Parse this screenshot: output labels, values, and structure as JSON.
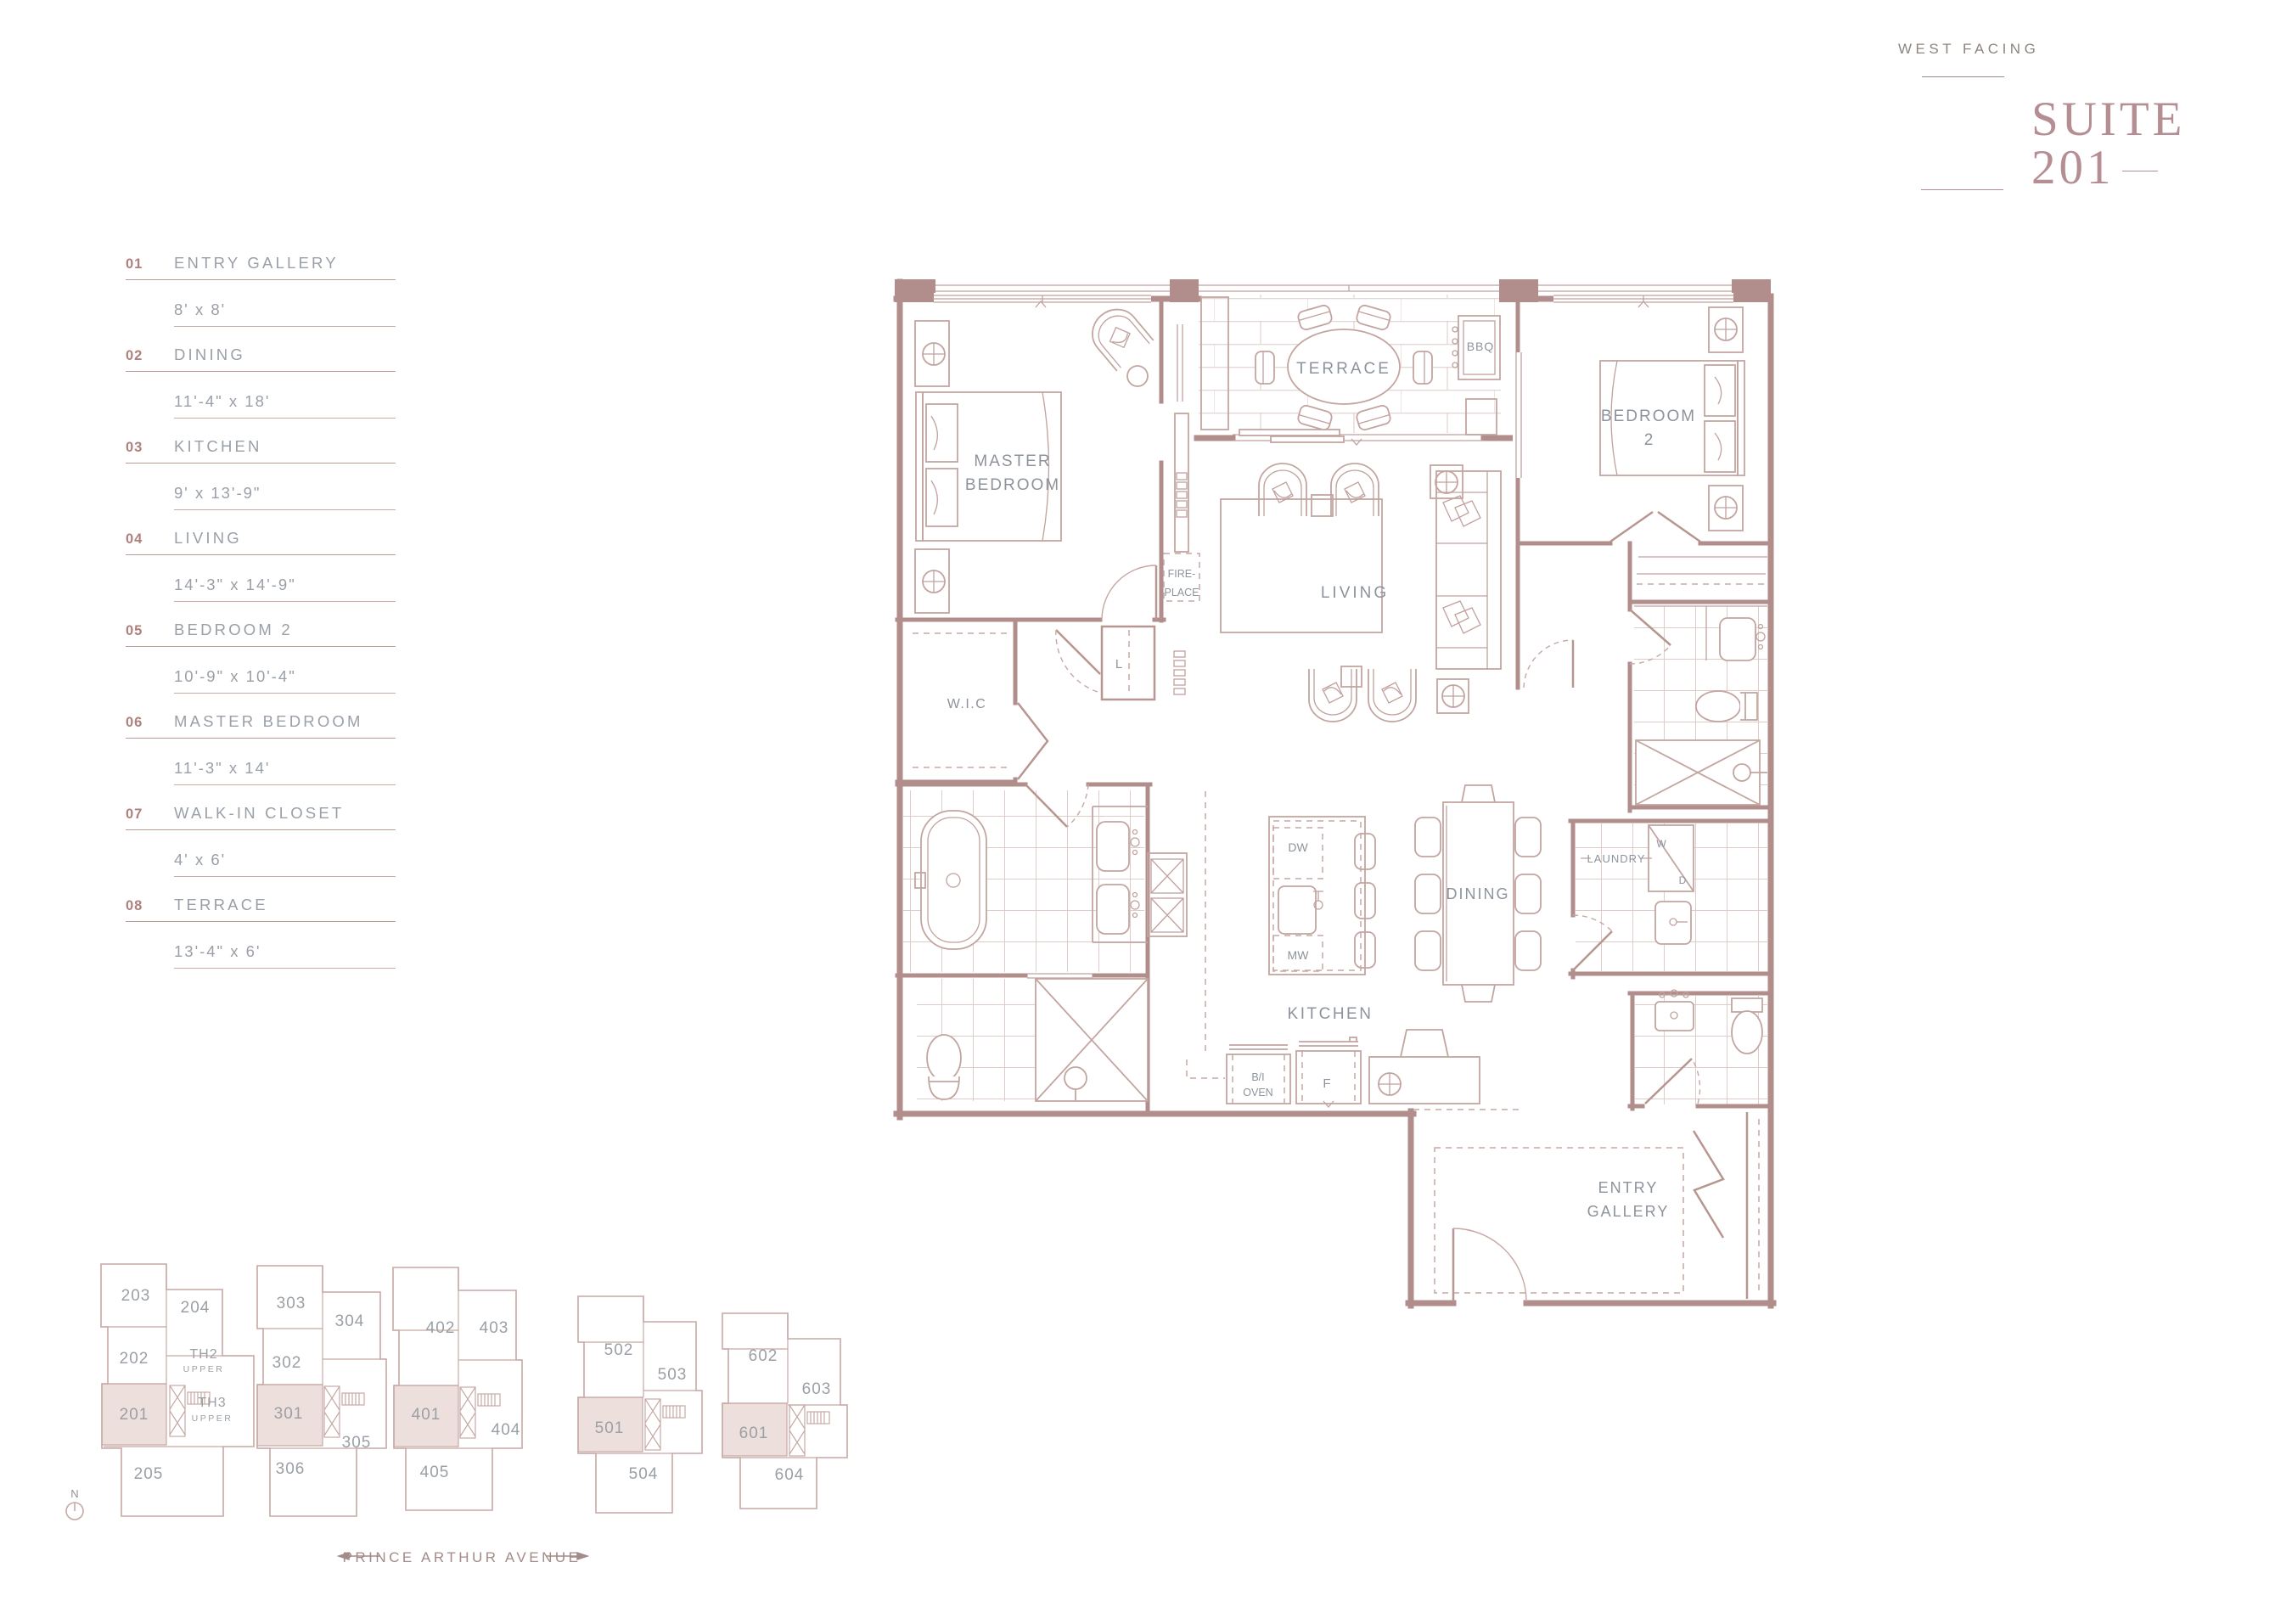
{
  "title": {
    "facing": "WEST FACING",
    "suite_label": "SUITE",
    "suite_number": "201"
  },
  "legend": {
    "items": [
      {
        "num": "01",
        "name": "ENTRY GALLERY",
        "dims": "8' x 8'"
      },
      {
        "num": "02",
        "name": "DINING",
        "dims": "11'-4\" x 18'"
      },
      {
        "num": "03",
        "name": "KITCHEN",
        "dims": "9' x 13'-9\""
      },
      {
        "num": "04",
        "name": "LIVING",
        "dims": "14'-3\" x 14'-9\""
      },
      {
        "num": "05",
        "name": "BEDROOM 2",
        "dims": "10'-9\" x 10'-4\""
      },
      {
        "num": "06",
        "name": "MASTER BEDROOM",
        "dims": "11'-3\" x 14'"
      },
      {
        "num": "07",
        "name": "WALK-IN CLOSET",
        "dims": "4' x 6'"
      },
      {
        "num": "08",
        "name": "TERRACE",
        "dims": "13'-4\" x 6'"
      }
    ]
  },
  "plan": {
    "labels": {
      "master_1": "MASTER",
      "master_2": "BEDROOM",
      "terrace": "TERRACE",
      "bbq": "BBQ",
      "bedroom2_1": "BEDROOM",
      "bedroom2_2": "2",
      "fire_1": "FIRE-",
      "fire_2": "PLACE",
      "living": "LIVING",
      "wic": "W.I.C",
      "linen": "L",
      "dw": "DW",
      "mw": "MW",
      "dining": "DINING",
      "kitchen": "KITCHEN",
      "oven_1": "B/I",
      "oven_2": "OVEN",
      "fridge": "F",
      "laundry": "LAUNDRY",
      "washer": "W",
      "dryer": "D",
      "entry_1": "ENTRY",
      "entry_2": "GALLERY"
    }
  },
  "keyplans": {
    "street": "PRINCE ARTHUR AVENUE",
    "north": "N",
    "floors": [
      {
        "units": [
          {
            "label": "203"
          },
          {
            "label": "204"
          },
          {
            "label": "202"
          },
          {
            "label": "TH2",
            "sub": "UPPER"
          },
          {
            "label": "201",
            "highlighted": true
          },
          {
            "label": "TH3",
            "sub": "UPPER"
          },
          {
            "label": "205"
          }
        ]
      },
      {
        "units": [
          {
            "label": "303"
          },
          {
            "label": "304"
          },
          {
            "label": "302"
          },
          {
            "label": "301",
            "highlighted": true
          },
          {
            "label": "305"
          },
          {
            "label": "306"
          }
        ]
      },
      {
        "units": [
          {
            "label": "402"
          },
          {
            "label": "403"
          },
          {
            "label": "401",
            "highlighted": true
          },
          {
            "label": "404"
          },
          {
            "label": "405"
          }
        ]
      },
      {
        "units": [
          {
            "label": "502"
          },
          {
            "label": "503"
          },
          {
            "label": "501",
            "highlighted": true
          },
          {
            "label": "504"
          }
        ]
      },
      {
        "units": [
          {
            "label": "602"
          },
          {
            "label": "603"
          },
          {
            "label": "601",
            "highlighted": true
          },
          {
            "label": "604"
          }
        ]
      }
    ]
  },
  "colors": {
    "wall": "#b18e8b",
    "furniture": "#c3a5a0",
    "tile": "#ddccc8",
    "label_gray": "#8d939c",
    "legend_number": "#ae807d",
    "title_rose": "#b48e92",
    "highlight_fill": "#ecdfdc",
    "background": "#ffffff"
  }
}
